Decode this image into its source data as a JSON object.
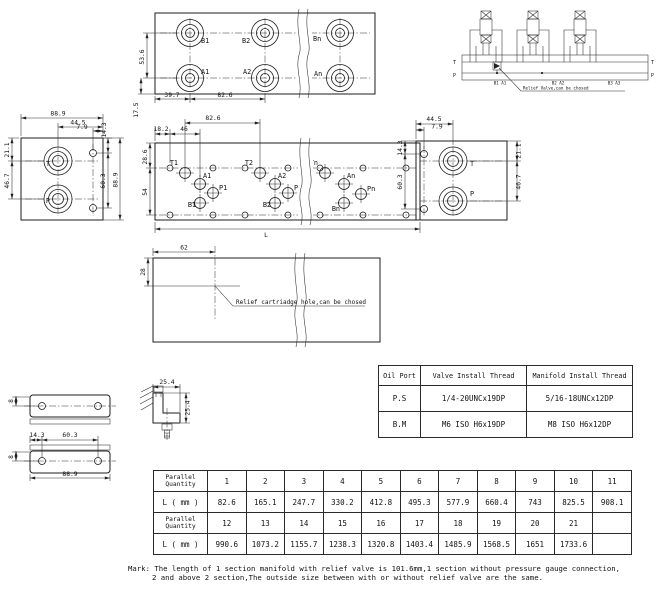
{
  "views": {
    "top": {
      "ports": {
        "b1": "B1",
        "b2": "B2",
        "bn": "Bn",
        "a1": "A1",
        "a2": "A2",
        "an": "An"
      },
      "dims": {
        "v1": "53.6",
        "v2": "17.5",
        "h1": "39.7",
        "h2": "82.6"
      }
    },
    "schematic": {
      "t_left": "T",
      "p_left": "P",
      "t_right": "T",
      "p_right": "P",
      "groups": [
        "B1 A1",
        "B2 A2",
        "B3 A3"
      ],
      "note": "Relief Valve,can be chosed"
    },
    "left_side": {
      "ports": {
        "t": "T",
        "p": "P"
      },
      "dims": {
        "width": "88.9",
        "d44_5": "44.5",
        "d7_9": "7.9",
        "d21_1": "21.1",
        "d46_7": "46.7",
        "d14_3": "14.3",
        "d60_3": "60.3",
        "height": "88.9"
      }
    },
    "front": {
      "dims": {
        "d82_6": "82.6",
        "d18_2": "18.2",
        "d46": "46",
        "d28_6": "28.6",
        "d54": "54",
        "length": "L"
      },
      "sections": [
        {
          "t": "T1",
          "a": "A1",
          "p": "P1",
          "b": "B1"
        },
        {
          "t": "T2",
          "a": "A2",
          "p": "P2",
          "b": "B2"
        },
        {
          "t": "Tn",
          "a": "An",
          "p": "Pn",
          "b": "Bn"
        }
      ]
    },
    "right_side": {
      "ports": {
        "t": "T",
        "p": "P"
      },
      "dims": {
        "d44_5": "44.5",
        "d7_9": "7.9",
        "d14_3": "14.3",
        "d60_3": "60.3",
        "d21_1": "21.1",
        "d46_7": "46.7"
      }
    },
    "section": {
      "dims": {
        "d62": "62",
        "d28": "28"
      },
      "note": "Relief cartriadge hole,can be chosed"
    },
    "bracket": {
      "dims": {
        "d8a": "8",
        "d14_3": "14.3",
        "d60_3": "60.3",
        "d8b": "8",
        "d88_9": "88.9",
        "d25_4a": "25.4",
        "d25_4b": "25.4"
      }
    }
  },
  "thread_table": {
    "headers": [
      "Oil Port",
      "Valve Install Thread",
      "Manifold Install Thread"
    ],
    "rows": [
      {
        "port": "P.S",
        "valve": "1/4-20UNCx19DP",
        "manifold": "5/16-18UNCx12DP"
      },
      {
        "port": "B.M",
        "valve": "M6 ISO H6x19DP",
        "manifold": "M8 ISO H6x12DP"
      }
    ]
  },
  "length_table": {
    "qty_label_line1": "Parallel",
    "qty_label_line2": "Quantity",
    "l_label": "L ( mm )",
    "row1_qty": [
      "1",
      "2",
      "3",
      "4",
      "5",
      "6",
      "7",
      "8",
      "9",
      "10",
      "11"
    ],
    "row1_len": [
      "82.6",
      "165.1",
      "247.7",
      "330.2",
      "412.8",
      "495.3",
      "577.9",
      "660.4",
      "743",
      "825.5",
      "908.1"
    ],
    "row2_qty": [
      "12",
      "13",
      "14",
      "15",
      "16",
      "17",
      "18",
      "19",
      "20",
      "21",
      ""
    ],
    "row2_len": [
      "990.6",
      "1073.2",
      "1155.7",
      "1238.3",
      "1320.8",
      "1403.4",
      "1485.9",
      "1568.5",
      "1651",
      "1733.6",
      ""
    ]
  },
  "mark": {
    "line1": "Mark: The length of 1 section manifold with relief valve is 101.6mm,1 section without pressure gauge connection,",
    "line2": "2 and above 2 section,The outside size between with or without relief valve are the same."
  }
}
